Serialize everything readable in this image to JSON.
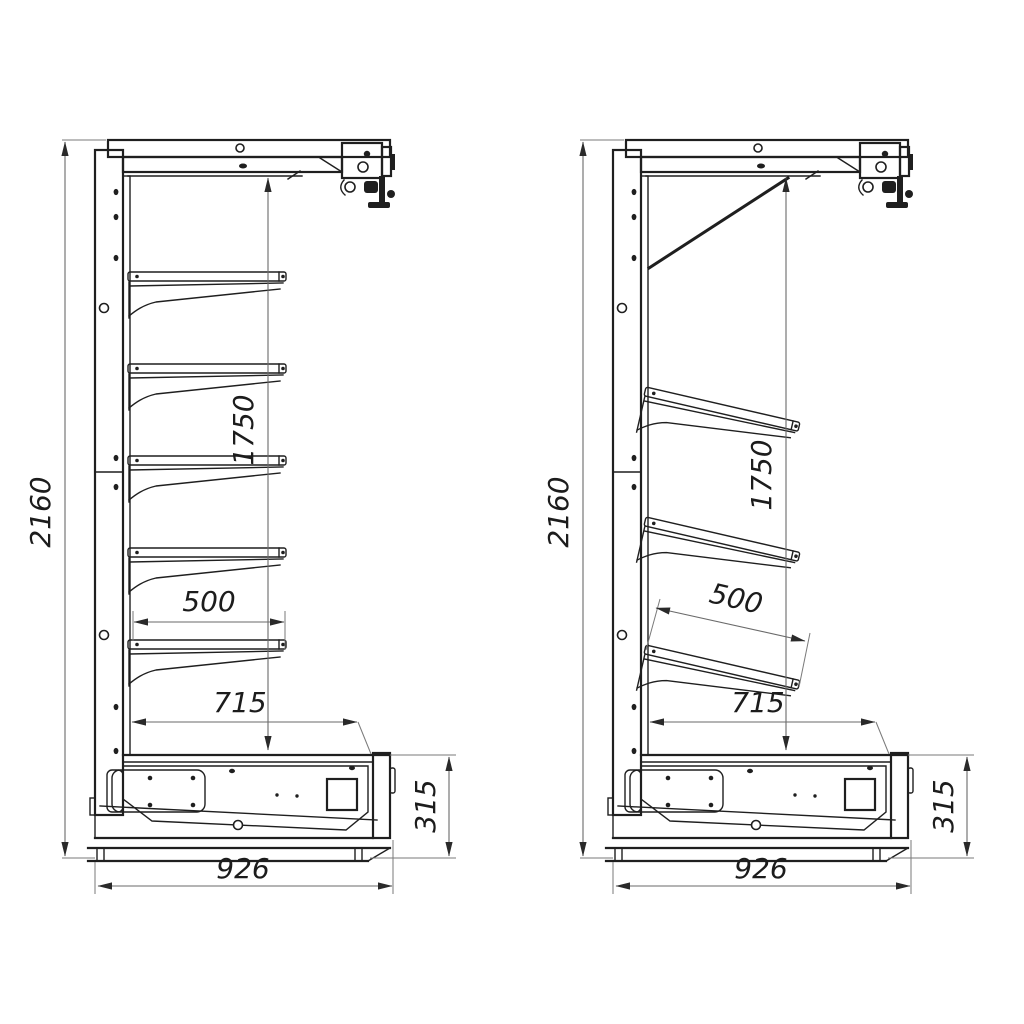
{
  "drawing": {
    "ink": "#1f1f1f",
    "dim_ink": "#6a6a6a",
    "views": [
      {
        "id": "left",
        "style": "horizontal-shelves",
        "shelf_count": 5,
        "dims": {
          "overall_height": "2160",
          "shelf_zone_height": "1750",
          "shelf_depth": "500",
          "well_depth": "715",
          "base_height": "315",
          "overall_depth": "926"
        }
      },
      {
        "id": "right",
        "style": "inclined-shelves",
        "shelf_count": 3,
        "dims": {
          "overall_height": "2160",
          "shelf_zone_height": "1750",
          "shelf_depth": "500",
          "well_depth": "715",
          "base_height": "315",
          "overall_depth": "926"
        }
      }
    ]
  }
}
